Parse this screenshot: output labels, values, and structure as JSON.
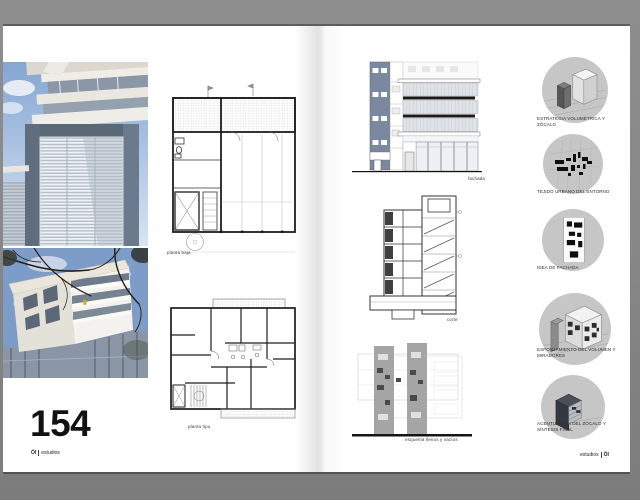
{
  "colors": {
    "backdrop": "#868686",
    "page": "#ffffff",
    "slate_facade": "#7b89a0",
    "step_circle": "#c6c6c6",
    "ink": "#1a1a1a",
    "diagram_gray": "#a5a5a5"
  },
  "left_page": {
    "photos": [
      {
        "name": "facade-looking-up-photo"
      },
      {
        "name": "building-corner-photo"
      }
    ],
    "plans": [
      {
        "caption": "planta baja"
      },
      {
        "caption": "planta tipo"
      }
    ],
    "page_number": "154",
    "footer": {
      "logo": "ÖI",
      "label": "estudios"
    }
  },
  "right_page": {
    "drawings": [
      {
        "caption": "fachada"
      },
      {
        "caption": "corte"
      },
      {
        "caption": "esquema llenos y vacíos"
      }
    ],
    "steps": [
      {
        "icon": "volume-plinth-icon",
        "caption": "ESTRATEGIA VOLUMÉTRICA Y ZÓCALO"
      },
      {
        "icon": "urban-fabric-icon",
        "caption": "TEJIDO URBANO DEL ENTORNO"
      },
      {
        "icon": "facade-idea-icon",
        "caption": "IDEA DE FACHADA"
      },
      {
        "icon": "hollowed-volume-icon",
        "caption": "ESPONJAMIENTO DEL VOLUMEN Y MIRADORES"
      },
      {
        "icon": "plinth-synthesis-icon",
        "caption": "ACENTUACIÓN DEL ZÓCALO Y SÍNTESIS FINAL"
      }
    ],
    "footer": {
      "label": "estudios",
      "logo": "ÖI"
    }
  }
}
